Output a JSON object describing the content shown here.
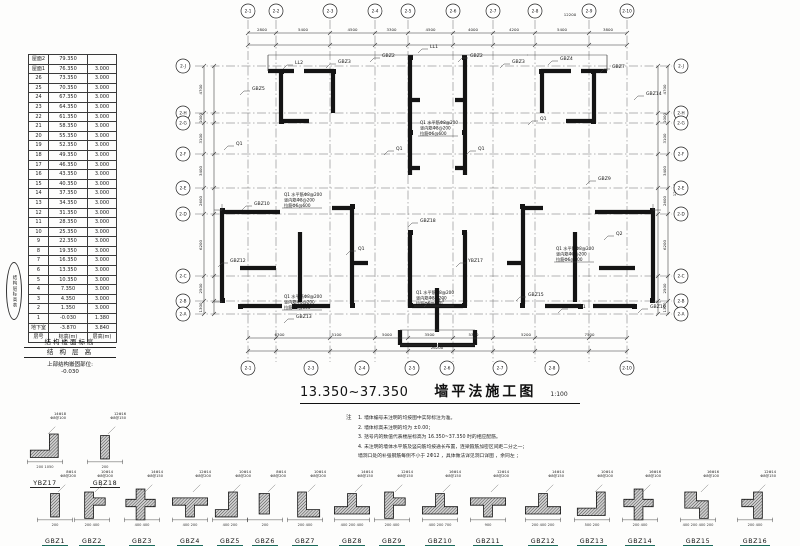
{
  "floor_table": {
    "columns": [
      "层号",
      "标高(m)",
      "层高(m)"
    ],
    "rows": [
      [
        "屋面2",
        "79.350",
        ""
      ],
      [
        "屋面1",
        "76.350",
        "3.000"
      ],
      [
        "26",
        "73.350",
        "3.000"
      ],
      [
        "25",
        "70.350",
        "3.000"
      ],
      [
        "24",
        "67.350",
        "3.000"
      ],
      [
        "23",
        "64.350",
        "3.000"
      ],
      [
        "22",
        "61.350",
        "3.000"
      ],
      [
        "21",
        "58.350",
        "3.000"
      ],
      [
        "20",
        "55.350",
        "3.000"
      ],
      [
        "19",
        "52.350",
        "3.000"
      ],
      [
        "18",
        "49.350",
        "3.000"
      ],
      [
        "17",
        "46.350",
        "3.000"
      ],
      [
        "16",
        "43.350",
        "3.000"
      ],
      [
        "15",
        "40.350",
        "3.000"
      ],
      [
        "14",
        "37.350",
        "3.000"
      ],
      [
        "13",
        "34.350",
        "3.000"
      ],
      [
        "12",
        "31.350",
        "3.000"
      ],
      [
        "11",
        "28.350",
        "3.000"
      ],
      [
        "10",
        "25.350",
        "3.000"
      ],
      [
        "9",
        "22.350",
        "3.000"
      ],
      [
        "8",
        "19.350",
        "3.000"
      ],
      [
        "7",
        "16.350",
        "3.000"
      ],
      [
        "6",
        "13.350",
        "3.000"
      ],
      [
        "5",
        "10.350",
        "3.000"
      ],
      [
        "4",
        "7.350",
        "3.000"
      ],
      [
        "3",
        "4.350",
        "3.000"
      ],
      [
        "2",
        "1.350",
        "3.000"
      ],
      [
        "1",
        "-0.030",
        "1.380"
      ],
      [
        "地下室",
        "-3.870",
        "3.840"
      ],
      [
        "层号",
        "标高(m)",
        "层高(m)"
      ]
    ],
    "caption1": "结构楼面标高",
    "caption2": "结 构 层 高",
    "footer_label": "上部结构嵌固部位:",
    "footer_value": "-0.030",
    "stamp": "结构层标高表"
  },
  "plan": {
    "axes_top": [
      {
        "x": 248,
        "label": "2-1"
      },
      {
        "x": 276,
        "label": "2-2"
      },
      {
        "x": 330,
        "label": "2-3"
      },
      {
        "x": 375,
        "label": "2-4"
      },
      {
        "x": 408,
        "label": "2-5"
      },
      {
        "x": 453,
        "label": "2-6"
      },
      {
        "x": 493,
        "label": "2-7"
      },
      {
        "x": 535,
        "label": "2-8"
      },
      {
        "x": 589,
        "label": "2-9"
      },
      {
        "x": 627,
        "label": "2-10"
      }
    ],
    "axes_bottom": [
      {
        "x": 248,
        "label": "2-1"
      },
      {
        "x": 311,
        "label": "2-3"
      },
      {
        "x": 362,
        "label": "2-4"
      },
      {
        "x": 412,
        "label": "2-5"
      },
      {
        "x": 447,
        "label": "2-6"
      },
      {
        "x": 500,
        "label": "2-7"
      },
      {
        "x": 552,
        "label": "2-8"
      },
      {
        "x": 627,
        "label": "2-10"
      }
    ],
    "axes_left": [
      {
        "y": 66,
        "label": "2-J"
      },
      {
        "y": 113,
        "label": "2-H"
      },
      {
        "y": 123,
        "label": "2-G"
      },
      {
        "y": 154,
        "label": "2-F"
      },
      {
        "y": 188,
        "label": "2-E"
      },
      {
        "y": 214,
        "label": "2-D"
      },
      {
        "y": 276,
        "label": "2-C"
      },
      {
        "y": 301,
        "label": "2-B"
      },
      {
        "y": 314,
        "label": "2-A"
      }
    ],
    "axes_right": [
      {
        "y": 66,
        "label": "2-J"
      },
      {
        "y": 113,
        "label": "2-H"
      },
      {
        "y": 123,
        "label": "2-G"
      },
      {
        "y": 154,
        "label": "2-F"
      },
      {
        "y": 188,
        "label": "2-E"
      },
      {
        "y": 214,
        "label": "2-D"
      },
      {
        "y": 276,
        "label": "2-C"
      },
      {
        "y": 301,
        "label": "2-B"
      },
      {
        "y": 314,
        "label": "2-A"
      }
    ],
    "dims_top": [
      "2800",
      "5400",
      "4500",
      "3300",
      "4500",
      "4000",
      "4200",
      "5400",
      "3800"
    ],
    "dims_bottom": [
      "6300",
      "5100",
      "5000",
      "3500",
      "5300",
      "5200",
      "7500"
    ],
    "dims_left": [
      "4700",
      "1000",
      "3100",
      "3400",
      "2600",
      "6200",
      "2500",
      "1300"
    ],
    "overall_top": "12200",
    "overall_bottom": "26200",
    "overall_right": "12600",
    "labels": [
      {
        "x": 252,
        "y": 90,
        "t": "GBZ5"
      },
      {
        "x": 295,
        "y": 64,
        "t": "LL2"
      },
      {
        "x": 338,
        "y": 63,
        "t": "GBZ3"
      },
      {
        "x": 382,
        "y": 57,
        "t": "GBZ2"
      },
      {
        "x": 430,
        "y": 48,
        "t": "LL1"
      },
      {
        "x": 470,
        "y": 57,
        "t": "GBZ2"
      },
      {
        "x": 512,
        "y": 63,
        "t": "GBZ3"
      },
      {
        "x": 560,
        "y": 60,
        "t": "GBZ4"
      },
      {
        "x": 612,
        "y": 68,
        "t": "GBZ7"
      },
      {
        "x": 646,
        "y": 95,
        "t": "GBZ14"
      },
      {
        "x": 236,
        "y": 145,
        "t": "Q1"
      },
      {
        "x": 254,
        "y": 205,
        "t": "GBZ10"
      },
      {
        "x": 230,
        "y": 262,
        "t": "GBZ12"
      },
      {
        "x": 296,
        "y": 318,
        "t": "GBZ13"
      },
      {
        "x": 358,
        "y": 250,
        "t": "Q1"
      },
      {
        "x": 396,
        "y": 150,
        "t": "Q1"
      },
      {
        "x": 478,
        "y": 150,
        "t": "Q1"
      },
      {
        "x": 420,
        "y": 222,
        "t": "GBZ18"
      },
      {
        "x": 468,
        "y": 262,
        "t": "YBZ17"
      },
      {
        "x": 528,
        "y": 296,
        "t": "GBZ15"
      },
      {
        "x": 570,
        "y": 308,
        "t": "GBZ11"
      },
      {
        "x": 616,
        "y": 235,
        "t": "Q2"
      },
      {
        "x": 650,
        "y": 308,
        "t": "GBZ16"
      },
      {
        "x": 436,
        "y": 302,
        "t": "LL3"
      },
      {
        "x": 540,
        "y": 120,
        "t": "Q1"
      },
      {
        "x": 598,
        "y": 180,
        "t": "GBZ9"
      }
    ],
    "textblocks": [
      {
        "x": 284,
        "y": 196,
        "lines": [
          "Q1 水平筋Φ8@200",
          "竖向筋Φ8@200",
          "拉筋Φ6@600"
        ]
      },
      {
        "x": 284,
        "y": 298,
        "lines": [
          "Q1 水平筋Φ8@200",
          "竖向筋Φ8@200",
          "拉筋Φ6@600"
        ]
      },
      {
        "x": 416,
        "y": 294,
        "lines": [
          "Q1 水平筋Φ8@200",
          "竖向筋Φ8@200",
          "拉筋Φ6@600"
        ]
      },
      {
        "x": 420,
        "y": 124,
        "lines": [
          "Q1 水平筋Φ8@200",
          "竖向筋Φ8@200",
          "拉筋Φ6@600"
        ]
      },
      {
        "x": 556,
        "y": 250,
        "lines": [
          "Q1 水平筋Φ8@200",
          "竖向筋Φ8@200",
          "拉筋Φ6@600"
        ]
      }
    ]
  },
  "title": {
    "range": "13.350~37.350",
    "text": "墙平法施工图",
    "scale": "1:100"
  },
  "notes": {
    "prefix": "注",
    "lines": [
      "1. 墙体编号未注明的均按图中实际标注为准。",
      "2. 墙体标高未注明的均为 ±0.00；",
      "3. 括号内的数值代表楼层标高为  16.350~37.350  时的相应配筋。",
      "4. 未注明的墙体水平筋及竖向筋均按通长布置，连梁箍筋加密区间距二分之一；",
      "    墙洞口处的补强钢筋每侧不小于   2Φ12 ，具体做法详见洞口详图    ，余同左 ；"
    ]
  },
  "details": [
    {
      "label": "YBZ17",
      "shape": "ltr",
      "note1": "14Φ18",
      "note2": "Φ8@100",
      "dim": "200  1050",
      "row": "A",
      "cx": 45
    },
    {
      "label": "GBZ18",
      "shape": "rv",
      "note1": "12Φ16",
      "note2": "Φ8@150",
      "dim": "200",
      "row": "A",
      "cx": 105
    },
    {
      "label": "GBZ1",
      "shape": "rv",
      "note1": "8Φ14",
      "note2": "Φ8@200",
      "dim": "200",
      "row": "B",
      "cx": 55
    },
    {
      "label": "GBZ2",
      "shape": "tr",
      "note1": "10Φ14",
      "note2": "Φ8@200",
      "dim": "200  400",
      "row": "B",
      "cx": 92
    },
    {
      "label": "GBZ3",
      "shape": "cx",
      "note1": "14Φ14",
      "note2": "Φ8@150",
      "dim": "400  400",
      "row": "B",
      "cx": 142
    },
    {
      "label": "GBZ4",
      "shape": "tdn",
      "note1": "12Φ14",
      "note2": "Φ8@200",
      "dim": "400  200",
      "row": "B",
      "cx": 190
    },
    {
      "label": "GBZ5",
      "shape": "lbl",
      "note1": "10Φ14",
      "note2": "Φ8@200",
      "dim": "400  200",
      "row": "B",
      "cx": 230
    },
    {
      "label": "GBZ6",
      "shape": "sq",
      "note1": "8Φ14",
      "note2": "Φ8@200",
      "dim": "200",
      "row": "B",
      "cx": 265
    },
    {
      "label": "GBZ7",
      "shape": "lbr",
      "note1": "10Φ14",
      "note2": "Φ8@200",
      "dim": "200  400",
      "row": "B",
      "cx": 305
    },
    {
      "label": "GBZ8",
      "shape": "tup",
      "note1": "14Φ14",
      "note2": "Φ8@150",
      "dim": "400  200  400",
      "row": "B",
      "cx": 352
    },
    {
      "label": "GBZ9",
      "shape": "tr",
      "note1": "12Φ14",
      "note2": "Φ8@150",
      "dim": "200  400",
      "row": "B",
      "cx": 392
    },
    {
      "label": "GBZ10",
      "shape": "tup",
      "note1": "16Φ14",
      "note2": "Φ8@150",
      "dim": "400  200  700",
      "row": "B",
      "cx": 440
    },
    {
      "label": "GBZ11",
      "shape": "tdn",
      "note1": "12Φ14",
      "note2": "Φ8@200",
      "dim": "900",
      "row": "B",
      "cx": 488
    },
    {
      "label": "GBZ12",
      "shape": "tup",
      "note1": "14Φ14",
      "note2": "Φ8@150",
      "dim": "200  400  200",
      "row": "B",
      "cx": 543
    },
    {
      "label": "GBZ13",
      "shape": "ltr",
      "note1": "10Φ14",
      "note2": "Φ8@200",
      "dim": "500  200",
      "row": "B",
      "cx": 592
    },
    {
      "label": "GBZ14",
      "shape": "cx",
      "note1": "16Φ16",
      "note2": "Φ8@100",
      "dim": "200  400",
      "row": "B",
      "cx": 640
    },
    {
      "label": "GBZ15",
      "shape": "z",
      "note1": "16Φ16",
      "note2": "Φ8@100",
      "dim": "400  200  400  200",
      "row": "B",
      "cx": 698
    },
    {
      "label": "GBZ16",
      "shape": "tl",
      "note1": "12Φ14",
      "note2": "Φ8@150",
      "dim": "200  400",
      "row": "B",
      "cx": 755
    }
  ]
}
